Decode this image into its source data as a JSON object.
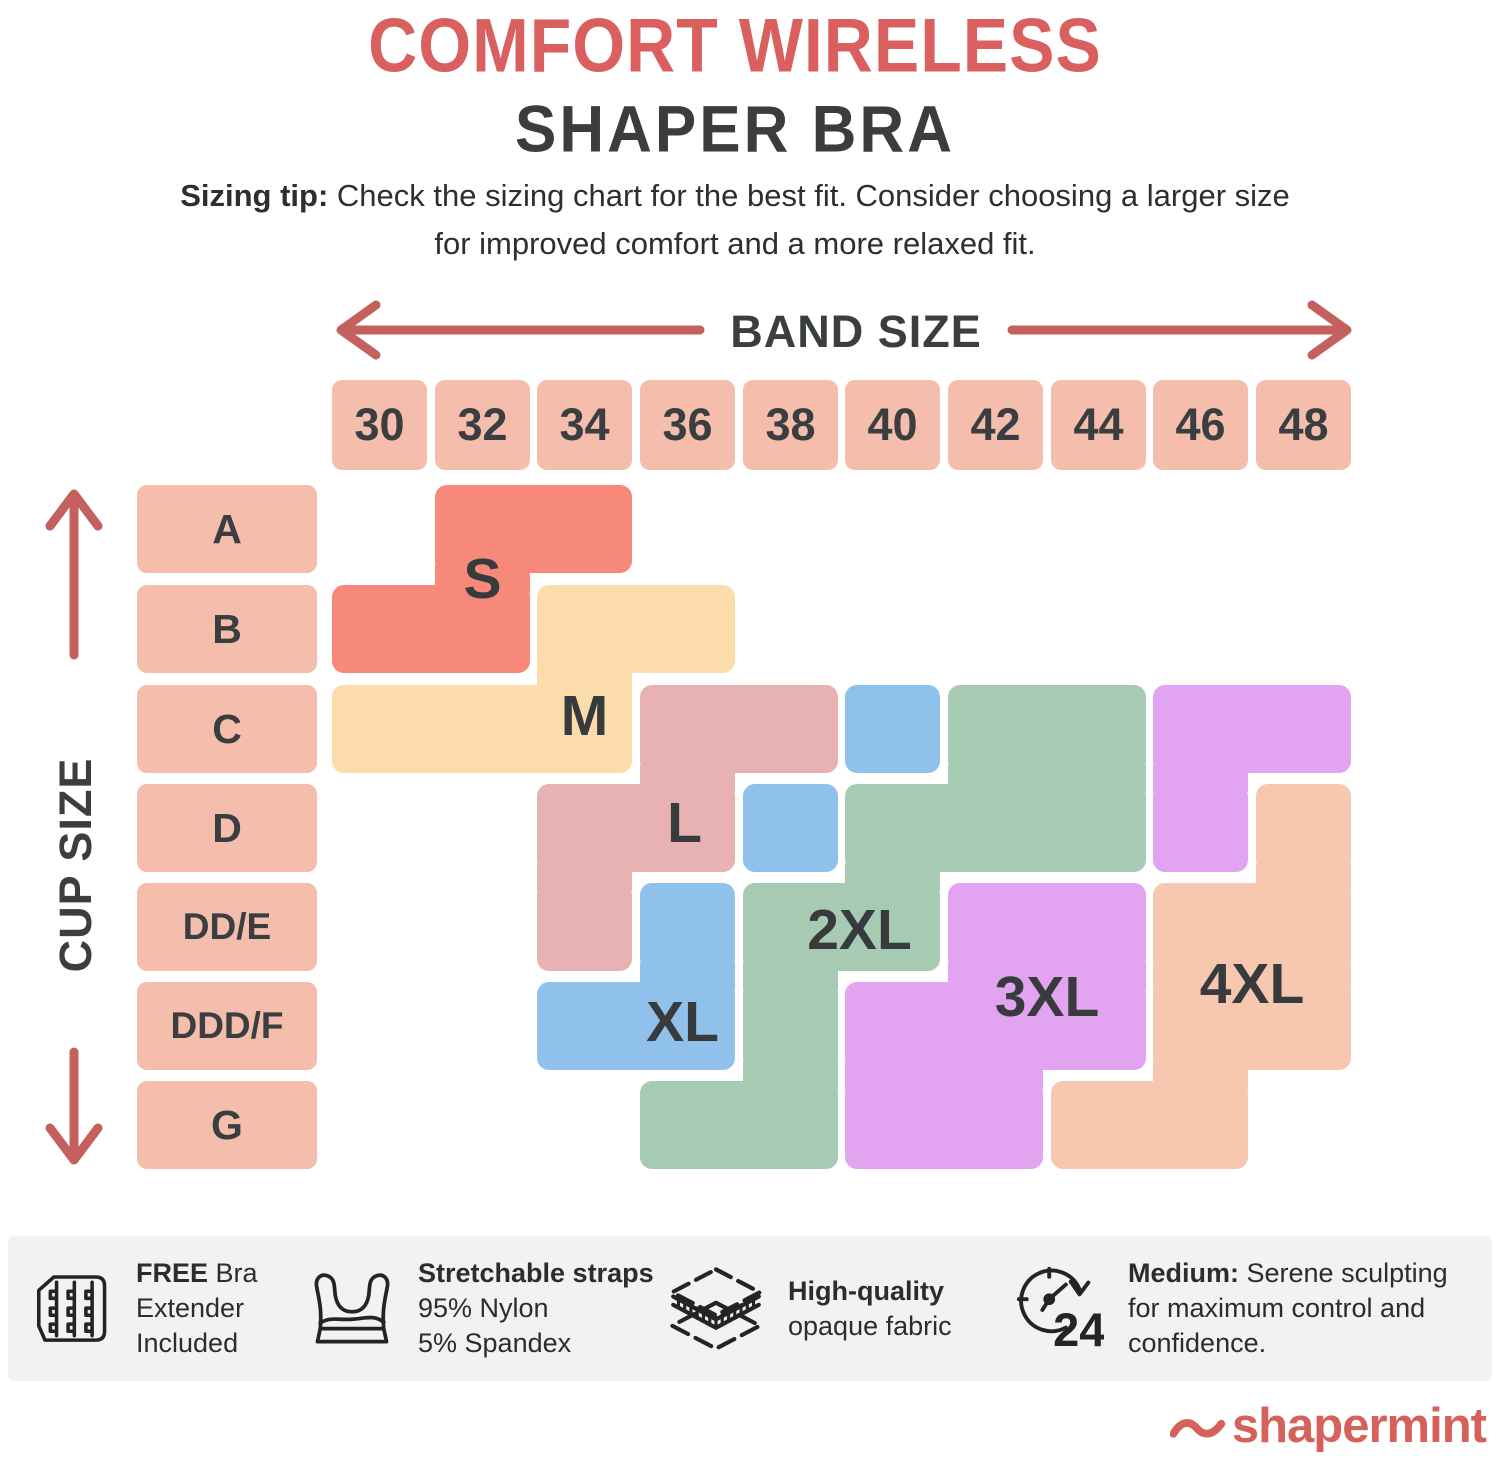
{
  "title": {
    "line1": "COMFORT WIRELESS",
    "line2": "SHAPER BRA"
  },
  "sizing_tip": {
    "bold": "Sizing tip:",
    "line1_rest": " Check the sizing chart for the best fit. Consider choosing a larger size",
    "line2": "for improved comfort and a more relaxed fit."
  },
  "axes": {
    "band_label": "BAND SIZE",
    "cup_label": "CUP SIZE"
  },
  "chart_data": {
    "type": "heatmap",
    "x_title": "BAND SIZE",
    "y_title": "CUP SIZE",
    "x_categories": [
      "30",
      "32",
      "34",
      "36",
      "38",
      "40",
      "42",
      "44",
      "46",
      "48"
    ],
    "y_categories": [
      "A",
      "B",
      "C",
      "D",
      "DD/E",
      "DDD/F",
      "G"
    ],
    "header_cell_color": "#f5bdab",
    "regions": [
      {
        "label": "S",
        "color": "#f6897a",
        "cells": [
          [
            "32",
            "A"
          ],
          [
            "34",
            "A"
          ],
          [
            "30",
            "B"
          ],
          [
            "32",
            "B"
          ]
        ],
        "label_anchor": {
          "cols": [
            "32"
          ],
          "rows": [
            "A",
            "B"
          ],
          "dx": 0,
          "dy": 0
        }
      },
      {
        "label": "M",
        "color": "#fcdcaa",
        "cells": [
          [
            "34",
            "B"
          ],
          [
            "36",
            "B"
          ],
          [
            "30",
            "C"
          ],
          [
            "32",
            "C"
          ],
          [
            "34",
            "C"
          ]
        ],
        "label_anchor": {
          "cols": [
            "34"
          ],
          "rows": [
            "C"
          ],
          "dx": 0,
          "dy": -13
        }
      },
      {
        "label": "L",
        "color": "#e8b2b2",
        "cells": [
          [
            "36",
            "C"
          ],
          [
            "38",
            "C"
          ],
          [
            "34",
            "D"
          ],
          [
            "36",
            "D"
          ],
          [
            "34",
            "DD/E"
          ]
        ],
        "label_anchor": {
          "cols": [
            "36"
          ],
          "rows": [
            "D"
          ],
          "dx": -3,
          "dy": -5
        }
      },
      {
        "label": "XL",
        "color": "#90c1ea",
        "cells": [
          [
            "40",
            "C"
          ],
          [
            "38",
            "D"
          ],
          [
            "36",
            "DD/E"
          ],
          [
            "34",
            "DDD/F"
          ],
          [
            "36",
            "DDD/F"
          ]
        ],
        "label_anchor": {
          "cols": [
            "36"
          ],
          "rows": [
            "DDD/F"
          ],
          "dx": -5,
          "dy": -4
        }
      },
      {
        "label": "2XL",
        "color": "#a7cbb2",
        "cells": [
          [
            "42",
            "C"
          ],
          [
            "44",
            "C"
          ],
          [
            "40",
            "D"
          ],
          [
            "42",
            "D"
          ],
          [
            "44",
            "D"
          ],
          [
            "38",
            "DD/E"
          ],
          [
            "40",
            "DD/E"
          ],
          [
            "38",
            "DDD/F"
          ],
          [
            "36",
            "G"
          ],
          [
            "38",
            "G"
          ]
        ],
        "label_anchor": {
          "cols": [
            "38",
            "40"
          ],
          "rows": [
            "DD/E"
          ],
          "dx": 18,
          "dy": 3
        }
      },
      {
        "label": "3XL",
        "color": "#e2a4f0",
        "cells": [
          [
            "46",
            "C"
          ],
          [
            "48",
            "C"
          ],
          [
            "46",
            "D"
          ],
          [
            "42",
            "DD/E"
          ],
          [
            "44",
            "DD/E"
          ],
          [
            "40",
            "DDD/F"
          ],
          [
            "42",
            "DDD/F"
          ],
          [
            "44",
            "DDD/F"
          ],
          [
            "40",
            "G"
          ],
          [
            "42",
            "G"
          ]
        ],
        "label_anchor": {
          "cols": [
            "42",
            "44"
          ],
          "rows": [
            "DDD/F"
          ],
          "dx": 0,
          "dy": -29
        }
      },
      {
        "label": "4XL",
        "color": "#f8c7b0",
        "cells": [
          [
            "48",
            "D"
          ],
          [
            "46",
            "DD/E"
          ],
          [
            "48",
            "DD/E"
          ],
          [
            "46",
            "DDD/F"
          ],
          [
            "48",
            "DDD/F"
          ],
          [
            "44",
            "G"
          ],
          [
            "46",
            "G"
          ]
        ],
        "label_anchor": {
          "cols": [
            "46",
            "48"
          ],
          "rows": [
            "DD/E",
            "DDD/F"
          ],
          "dx": 0,
          "dy": 7
        }
      }
    ]
  },
  "features": [
    {
      "icon": "bra-extender-icon",
      "lines": [
        [
          {
            "b": "FREE"
          },
          {
            "t": " Bra"
          }
        ],
        [
          {
            "t": "Extender"
          }
        ],
        [
          {
            "t": "Included"
          }
        ]
      ]
    },
    {
      "icon": "bra-icon",
      "lines": [
        [
          {
            "b": "Stretchable straps"
          }
        ],
        [
          {
            "t": "95% Nylon"
          }
        ],
        [
          {
            "t": "5% Spandex"
          }
        ]
      ]
    },
    {
      "icon": "fabric-layers-icon",
      "lines": [
        [
          {
            "b": "High-quality"
          }
        ],
        [
          {
            "t": "opaque fabric"
          }
        ]
      ]
    },
    {
      "icon": "clock-24-icon",
      "badge": "24",
      "lines": [
        [
          {
            "b": "Medium:"
          },
          {
            "t": " Serene sculpting"
          }
        ],
        [
          {
            "t": "for maximum control and"
          }
        ],
        [
          {
            "t": "confidence."
          }
        ]
      ]
    }
  ],
  "logo": {
    "text": "shapermint"
  }
}
